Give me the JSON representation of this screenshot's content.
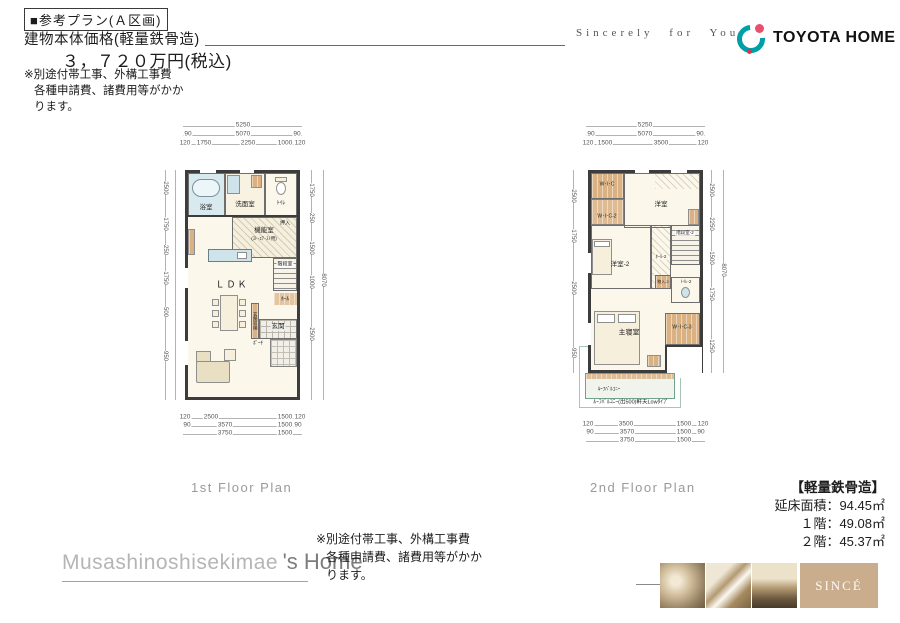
{
  "header": {
    "plan_title": "■参考プラン(Ａ区画)",
    "price_label": "建物本体価格(軽量鉄骨造)",
    "price_value": "３，７２０万円(税込)",
    "note": [
      "※別途付帯工事、外構工事費",
      "各種申請費、諸費用等がかか",
      "ります。"
    ],
    "slogan": "Sincerely for You",
    "brand_name": "TOYOTA HOME",
    "brand_teal": "#009FA8",
    "brand_pink": "#E8506B"
  },
  "plan1": {
    "caption": "1st  Floor Plan",
    "rooms": {
      "bath": "浴室",
      "washroom": "洗面室",
      "toilet": "ﾄｲﾚ",
      "closet": "押入",
      "utility": "機能室",
      "utility_note": "(ｽﾄ･ｴｱ･ｽﾄ用)",
      "stairs": "階段室",
      "ldk": "ＬＤＫ",
      "hall": "ﾎｰﾙ",
      "entrance": "玄関",
      "entrance_storage": "玄関収納",
      "porch": "ﾎﾟｰﾁ"
    },
    "dims": {
      "top1": "5250",
      "top2": [
        "90",
        "5070",
        "90"
      ],
      "top3": [
        "120",
        "1750",
        "2250",
        "1000",
        "120"
      ],
      "bot1": [
        "120",
        "2500",
        "1500",
        "120"
      ],
      "bot2": [
        "90",
        "3570",
        "1500",
        "90"
      ],
      "bot3": [
        "3750",
        "1500"
      ],
      "left": [
        "2500",
        "1750",
        "250",
        "1750",
        "500",
        "950"
      ],
      "right": [
        "1750",
        "250",
        "1500",
        "1000",
        "2500"
      ],
      "right_total": "8070"
    }
  },
  "plan2": {
    "caption": "2nd  Floor Plan",
    "rooms": {
      "wic": "W･I･C",
      "wic2": "W･I･C-2",
      "bedroom": "洋室",
      "bedroom2": "洋室-2",
      "hall2": "ﾎｰﾙ-2",
      "stairs2": "階段室-2",
      "storage2": "物入-2",
      "toilet2": "ﾄｲﾚ-2",
      "wic3": "W･I･C-3",
      "master": "主寝室",
      "balcony": "ﾙｰﾌﾊﾞﾙｺﾆｰ",
      "balcony_note": "ﾙｰﾌﾊﾞﾙｺﾆｰ(出500)軒天Lowﾀｲﾌﾟ"
    },
    "dims": {
      "top1": "5250",
      "top2": [
        "90",
        "5070",
        "90"
      ],
      "top3": [
        "120",
        "1500",
        "3500",
        "120"
      ],
      "bot1": [
        "120",
        "3500",
        "1500",
        "120"
      ],
      "bot2": [
        "90",
        "3570",
        "1500",
        "90"
      ],
      "bot3": [
        "3750",
        "1500"
      ],
      "left": [
        "2500",
        "1750",
        "2500",
        "950"
      ],
      "right": [
        "2500",
        "2250",
        "1500",
        "1750",
        "1250"
      ],
      "right_total": "8070"
    }
  },
  "specs": {
    "title": "【軽量鉄骨造】",
    "lines": [
      "延床面積：94.45㎡",
      "１階：49.08㎡",
      "２階：45.37㎡"
    ]
  },
  "footer": {
    "name_light": "Musashinoshisekimae",
    "name_dark": "'s Home",
    "note": [
      "※別途付帯工事、外構工事費",
      "各種申請費、諸費用等がかか",
      "ります。"
    ],
    "since": "SINCÉ",
    "since_bg": "#C9AD8C"
  }
}
